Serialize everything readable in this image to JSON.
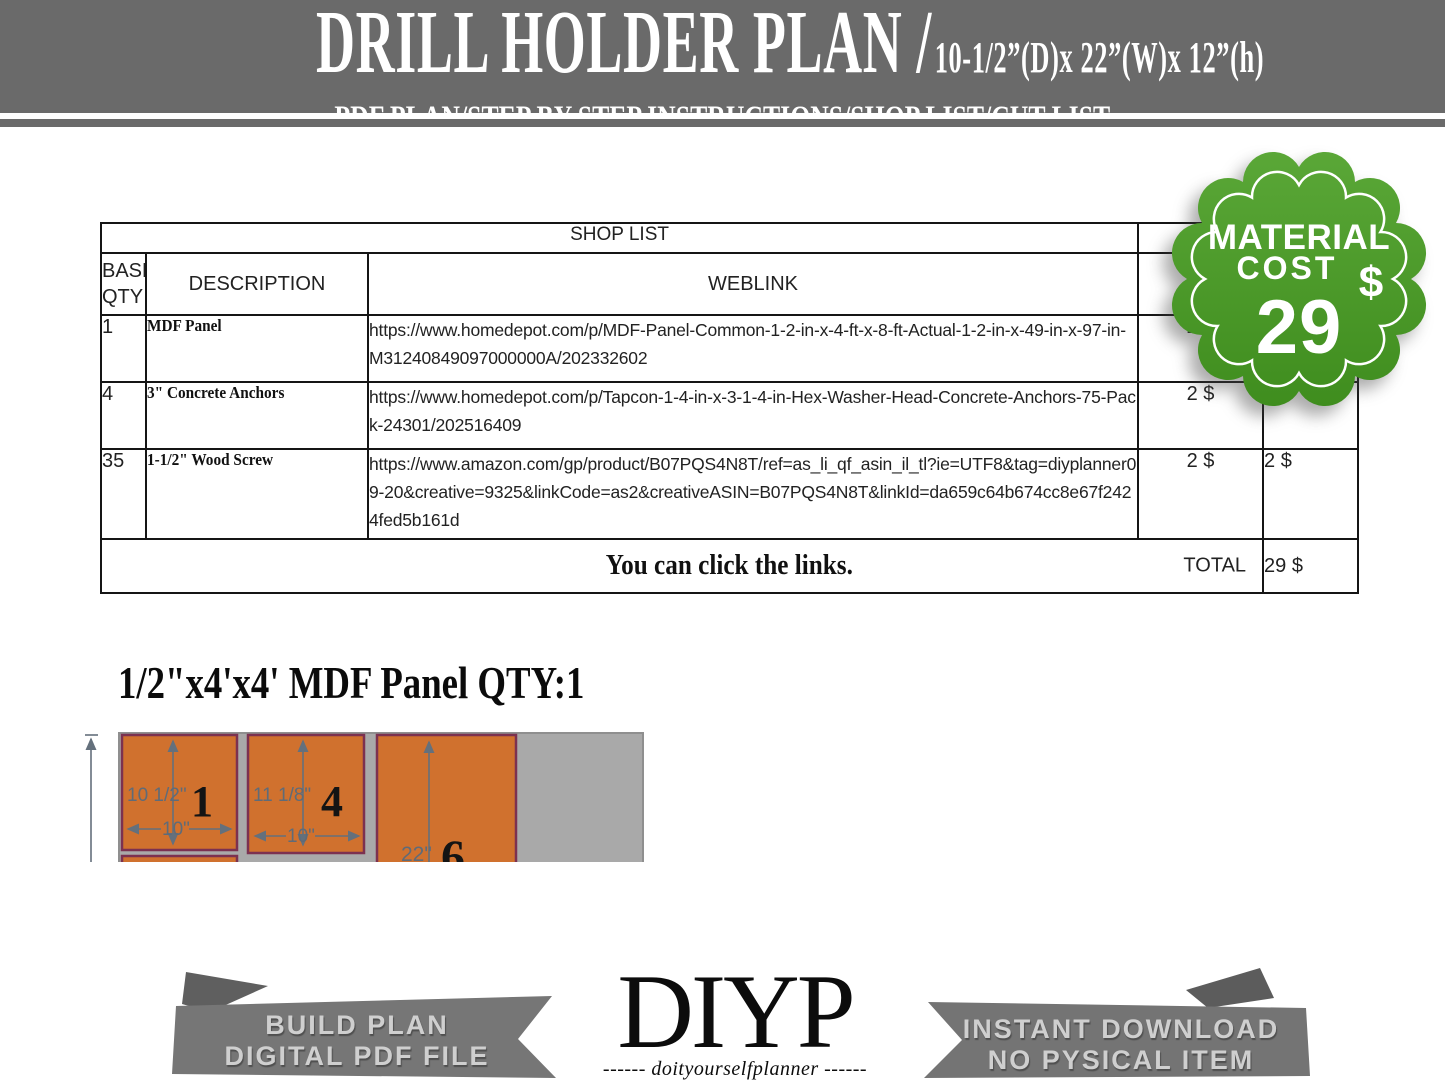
{
  "header": {
    "title": "DRILL HOLDER PLAN /",
    "dimensions": "10-1/2”(D)x 22”(W)x 12”(h)",
    "subtitle": "PDF PLAN/STEP BY STEP INSTRUCTIONS/SHOP LIST/CUT LIST"
  },
  "badge": {
    "line1": "MATERIAL",
    "line2": "COST",
    "currency": "$",
    "value": "29",
    "color_top": "#5aa737",
    "color_bottom": "#3f8d1e"
  },
  "shop_list": {
    "title": "SHOP LIST",
    "columns": {
      "qty": "BASE\nQTY",
      "description": "DESCRIPTION",
      "weblink": "WEBLINK"
    },
    "rows": [
      {
        "qty": "1",
        "description": "MDF Panel",
        "weblink": "https://www.homedepot.com/p/MDF-Panel-Common-1-2-in-x-4-ft-x-8-ft-Actual-1-2-in-x-49-in-x-97-in-M31240849097000000A/202332602",
        "price": "2 $",
        "price2": ""
      },
      {
        "qty": "4",
        "description": "3\" Concrete Anchors",
        "weblink": "https://www.homedepot.com/p/Tapcon-1-4-in-x-3-1-4-in-Hex-Washer-Head-Concrete-Anchors-75-Pack-24301/202516409",
        "price": "2 $",
        "price2": "2 $"
      },
      {
        "qty": "35",
        "description": "1-1/2\" Wood Screw",
        "weblink": "https://www.amazon.com/gp/product/B07PQS4N8T/ref=as_li_qf_asin_il_tl?ie=UTF8&tag=diyplanner09-20&creative=9325&linkCode=as2&creativeASIN=B07PQS4N8T&linkId=da659c64b674cc8e67f2424fed5b161d",
        "price": "2 $",
        "price2": "2 $"
      }
    ],
    "footer_note": "You can click the links.",
    "total_label": "TOTAL",
    "total_value": "29 $"
  },
  "cut_section": {
    "title": "1/2\"x4'x4' MDF Panel QTY:1",
    "sheet_color": "#a9a9a9",
    "piece_color": "#d0712e",
    "piece_border": "#7c3150",
    "dim_color": "#64707c",
    "pieces": [
      {
        "number": "1",
        "height_label": "10 1/2\"",
        "width_label": "10\""
      },
      {
        "number": "4",
        "height_label": "11 1/8\"",
        "width_label": "10\""
      },
      {
        "number": "6",
        "height_label": "22\"",
        "width_label": ""
      }
    ]
  },
  "footer": {
    "left_ribbon": {
      "line1": "BUILD PLAN",
      "line2": "DIGITAL PDF FILE"
    },
    "logo": {
      "text": "DIYP",
      "subtext": "------ doityourselfplanner ------"
    },
    "right_ribbon": {
      "line1": "INSTANT DOWNLOAD",
      "line2": "NO PYSICAL ITEM"
    }
  }
}
